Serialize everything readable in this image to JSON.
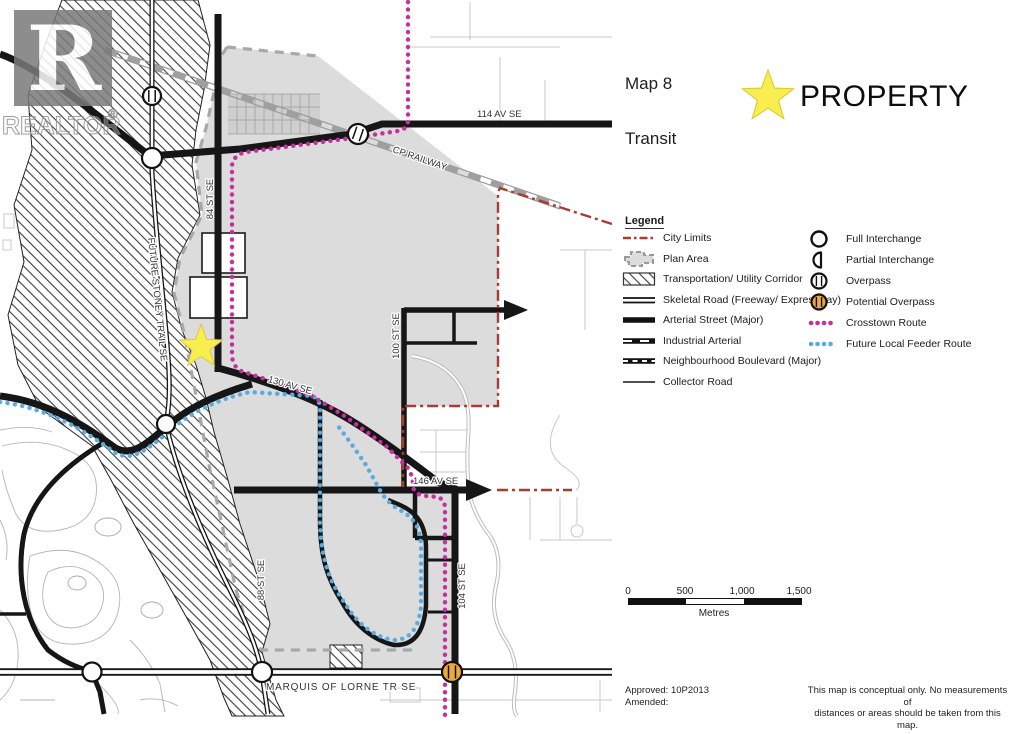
{
  "header": {
    "map_label": "Map 8",
    "subtitle": "Transit",
    "property_label": "PROPERTY"
  },
  "legend": {
    "title": "Legend",
    "left_items": [
      "City Limits",
      "Plan Area",
      "Transportation/ Utility Corridor",
      "Skeletal Road (Freeway/ Expressway)",
      "Arterial Street (Major)",
      "Industrial Arterial",
      "Neighbourhood Boulevard (Major)",
      "Collector Road"
    ],
    "right_items": [
      "Full Interchange",
      "Partial Interchange",
      "Overpass",
      "Potential Overpass",
      "Crosstown Route",
      "Future Local Feeder Route"
    ]
  },
  "scale": {
    "ticks": [
      "0",
      "500",
      "1,000",
      "1,500"
    ],
    "unit": "Metres"
  },
  "footer": {
    "approved": "Approved: 10P2013",
    "amended": "Amended:",
    "disclaimer1": "This map is conceptual only. No measurements of",
    "disclaimer2": "distances or areas should be taken from this map."
  },
  "watermark": {
    "letter": "R",
    "word": "REALTOR",
    "registered": "®"
  },
  "map_labels": {
    "av114": "114 AV SE",
    "railway": "CP RAILWAY",
    "st84": "84 ST SE",
    "stoney": "FUTURE STONEY TRAIL SE",
    "av130": "130 AV SE",
    "st100": "100 ST SE",
    "av146": "146 AV SE",
    "st88": "88 ST SE",
    "st104": "104 ST SE",
    "marquis": "MARQUIS OF LORNE TR SE"
  },
  "colors": {
    "crosstown": "#c4309c",
    "feeder": "#5aabdf",
    "city_limits": "#a83c32",
    "property_star": "#f8ee4f",
    "potential_overpass": "#eba93e",
    "plan_area": "#dcdcdc"
  }
}
